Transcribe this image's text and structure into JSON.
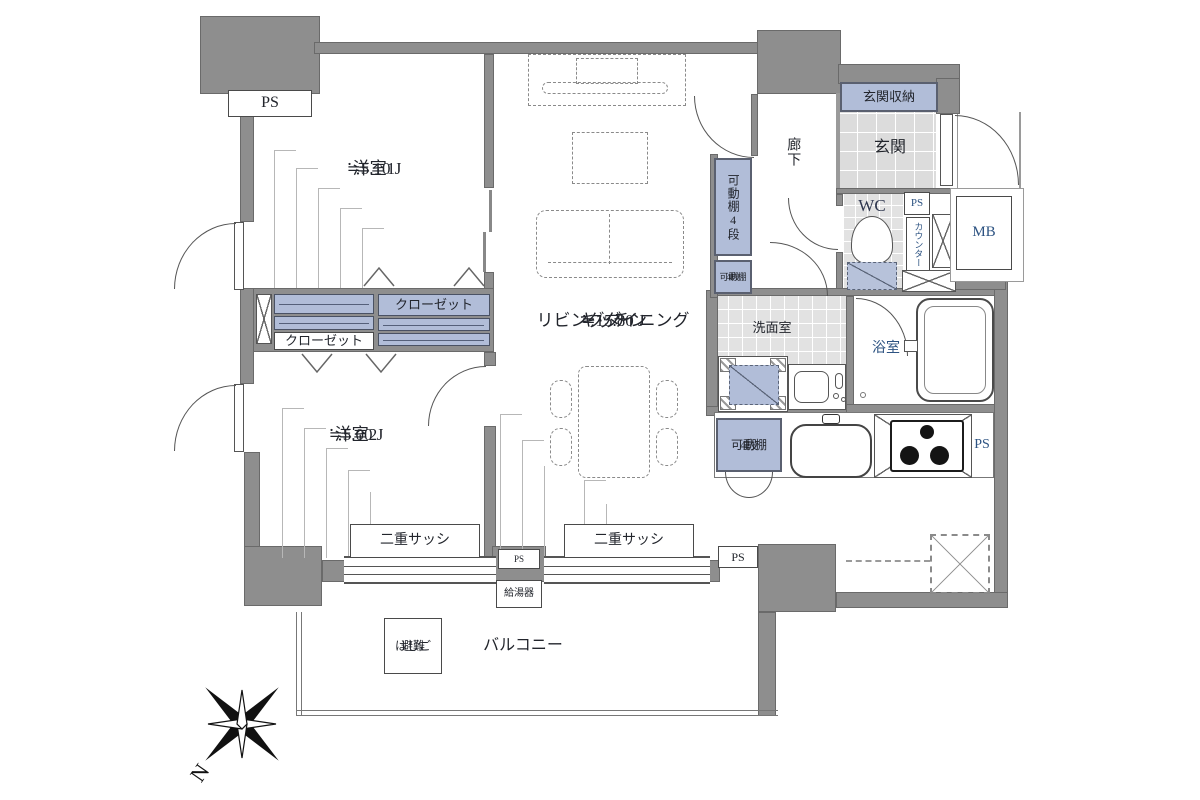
{
  "plan": {
    "bedroom1": {
      "name": "洋室1",
      "area": "≒5.10 J"
    },
    "bedroom2": {
      "name": "洋室2",
      "area": "≒5.00 J"
    },
    "ldk": {
      "name_line1": "リビングダイニング",
      "name_line2": "キッチン",
      "area": "≒15.80 J"
    },
    "hallway": {
      "name": "廊下"
    },
    "entrance": {
      "name": "玄関"
    },
    "entrance_storage": {
      "name": "玄関収納"
    },
    "toilet": {
      "name": "WC"
    },
    "washroom": {
      "name": "洗面室"
    },
    "bathroom": {
      "name": "浴室"
    },
    "balcony": {
      "name": "バルコニー"
    }
  },
  "labels": {
    "pipe_space": "PS",
    "meter_box": "MB",
    "counter": "カウンター",
    "closet": "クローゼット",
    "movable_shelf": "可動棚4段",
    "movable_shelf_line1": "可動棚",
    "movable_shelf_line2": "4段",
    "double_sash": "二重サッシ",
    "water_heater": "給湯器",
    "escape_ladder_line1": "避難",
    "escape_ladder_line2": "はしご",
    "compass_north": "N"
  },
  "colors": {
    "wall_gray": "#8e8e8e",
    "fixture_blue": "#b1bdd8",
    "tile_gray": "#e2e2e2",
    "text_dark": "#22252c",
    "text_navy": "#2d5382"
  }
}
